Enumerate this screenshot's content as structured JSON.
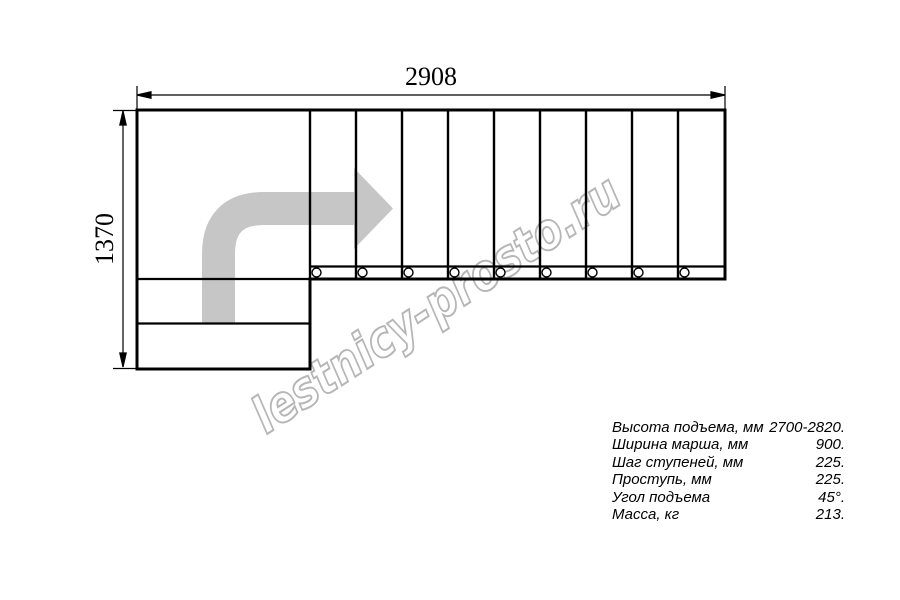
{
  "watermark": {
    "text": "lestnicy-prosto.ru",
    "color": "#b6b6b6"
  },
  "drawing": {
    "type": "staircase-floor-plan",
    "overall_width_mm": "2908",
    "overall_depth_mm": "1370",
    "tread_count": 9,
    "lower_steps_count": 2,
    "line_color": "#000000",
    "direction_arrow_color": "#c6c6c6"
  },
  "specs": {
    "rows": [
      {
        "label": "Высота подъема, мм",
        "value": "2700-2820."
      },
      {
        "label": "Ширина марша, мм",
        "value": "900."
      },
      {
        "label": "Шаг ступеней, мм",
        "value": "225."
      },
      {
        "label": "Проступь, мм",
        "value": "225."
      },
      {
        "label": "Угол подъема",
        "value": "45°."
      },
      {
        "label": "Масса, кг",
        "value": "213."
      }
    ]
  }
}
